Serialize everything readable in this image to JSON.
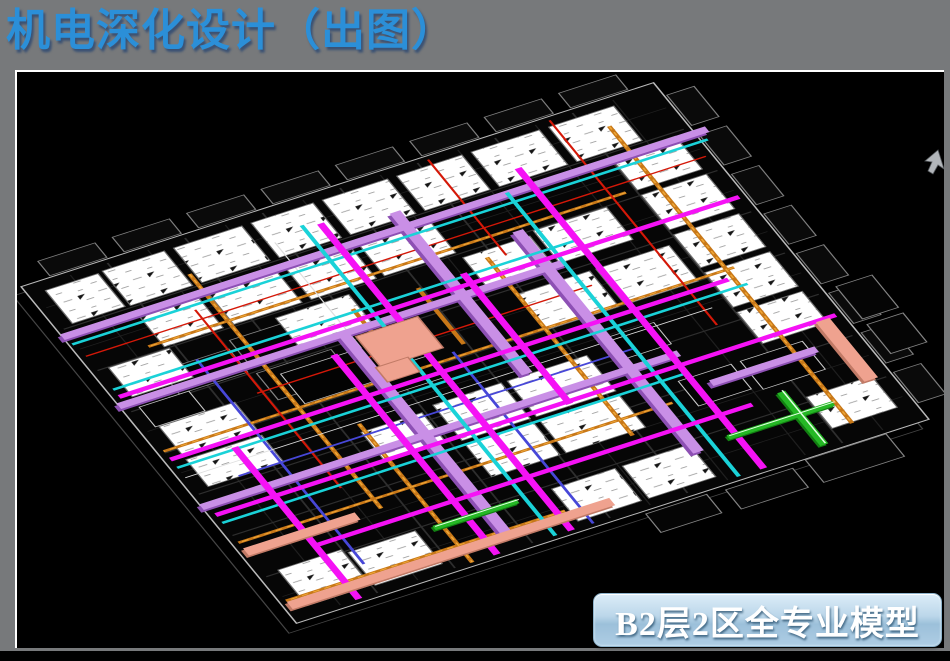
{
  "slide": {
    "title": "机电深化设计（出图）",
    "model_caption": "B2层2区全专业模型"
  },
  "colors": {
    "slide_bg": "#77797b",
    "title_text": "#2b8fd8",
    "viewport_bg": "#000000",
    "viewport_border": "#ffffff",
    "caption_text": "#ffffff",
    "caption_top": "#dcedf8",
    "caption_bottom": "#aecde4",
    "room_fill": "#ffffff",
    "duct_violet": "#c98fe6",
    "pipe_magenta": "#f512f5",
    "pipe_cyan": "#1ad2d8",
    "tray_orange": "#c87818",
    "pipe_red": "#d41808",
    "pipe_blue": "#4747d8",
    "duct_salmon": "#efa28f",
    "duct_green": "#25b825"
  }
}
